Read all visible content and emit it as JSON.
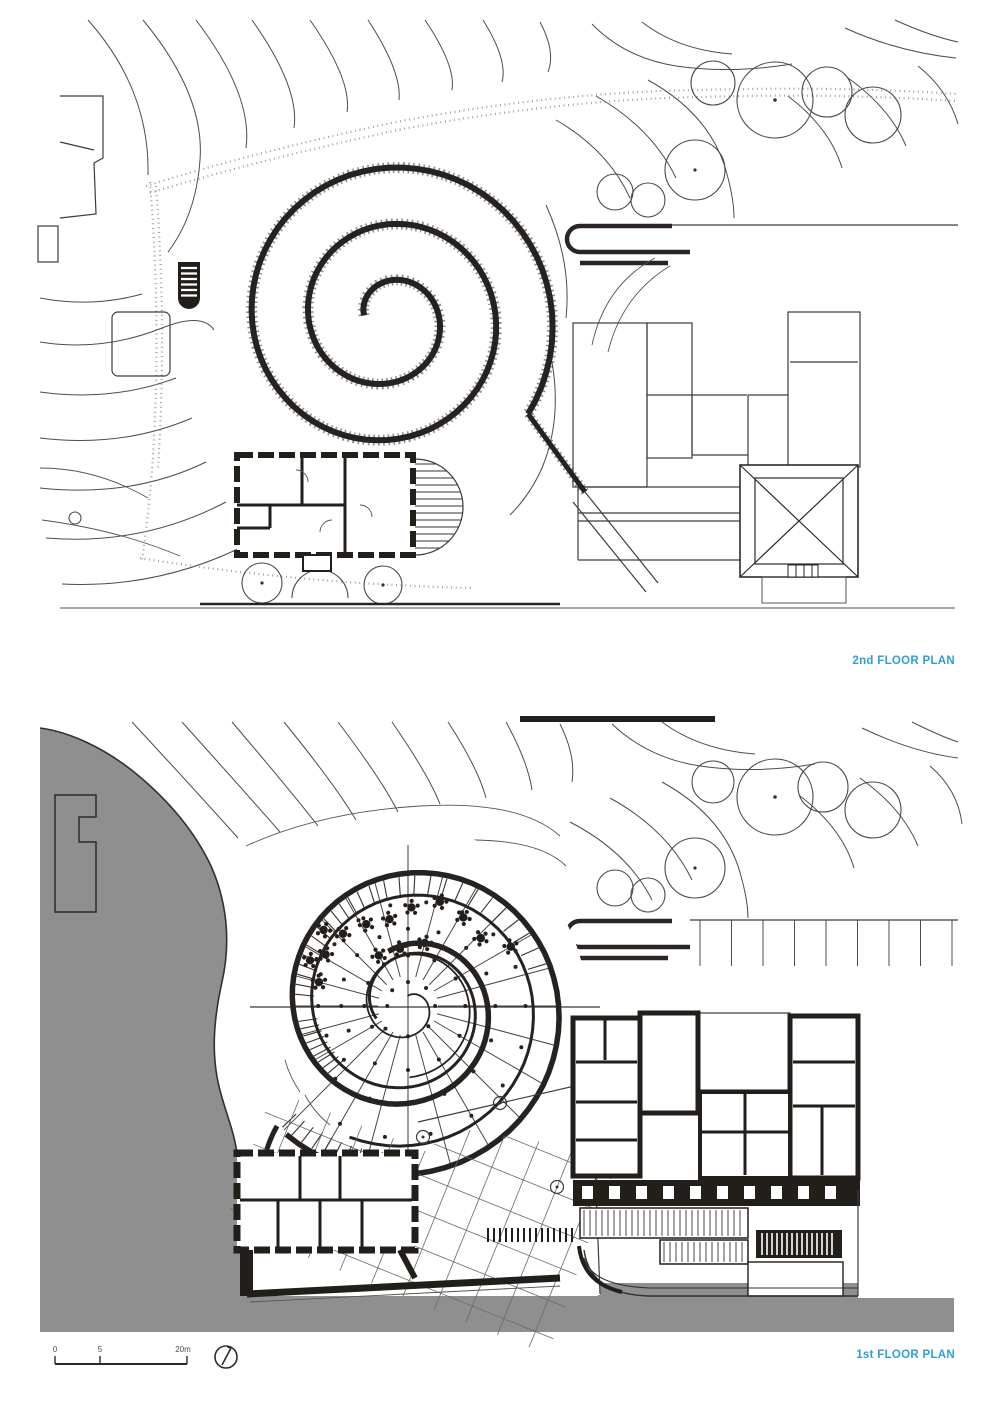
{
  "plans": {
    "second": {
      "label": "2nd FLOOR PLAN"
    },
    "first": {
      "label": "1st FLOOR PLAN"
    }
  },
  "scale_bar": {
    "tick_start": "0",
    "tick_mid": "5",
    "tick_end": "20m"
  },
  "colors": {
    "label_blue": "#2d9fd8",
    "terrain_gray": "#8f8f8f",
    "ink": "#2a2522",
    "line_gray": "#4c4c4c"
  },
  "icons": [
    {
      "name": "north-arrow-icon"
    },
    {
      "name": "stairs-icon"
    }
  ]
}
